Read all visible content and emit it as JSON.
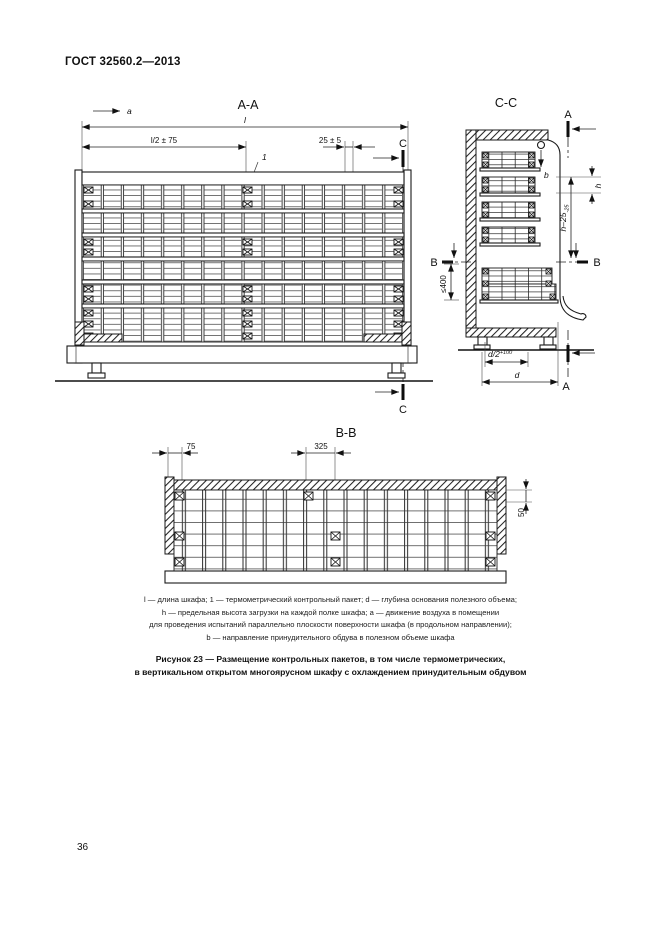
{
  "page": {
    "header": "ГОСТ 32560.2—2013",
    "page_number": "36"
  },
  "drawing": {
    "aa": {
      "title": "А-А",
      "flow_a": "a",
      "dim_l": "l",
      "dim_l2": "l/2 ± 75",
      "dim_25": "25 ± 5",
      "packet_ref": "1",
      "section_c": "С"
    },
    "cc": {
      "title": "С-С",
      "section_a": "А",
      "flow_b": "b",
      "dim_h": "h",
      "dim_hminus": "h–25",
      "dim_hminus_tol": "-25",
      "section_b": "В",
      "dim_400": "≤400",
      "dim_d2": "d/2",
      "dim_d2_tol": "+100",
      "dim_d": "d"
    },
    "bb": {
      "title": "В-В",
      "dim_75": "75",
      "dim_325": "325",
      "dim_50": "50"
    }
  },
  "legend": {
    "lines": [
      "l — длина шкафа; 1 — термометрический контрольный пакет; d — глубина основания полезного объема;",
      "h — предельная высота загрузки на каждой полке шкафа; a — движение воздуха в помещении",
      "для проведения испытаний параллельно плоскости поверхности шкафа (в продольном направлении);",
      "b — направление принудительного обдува в полезном объеме шкафа"
    ]
  },
  "caption": {
    "line1": "Рисунок 23 — Размещение контрольных пакетов, в том числе термометрических,",
    "line2": "в вертикальном открытом многоярусном шкафу с охлаждением принудительным обдувом"
  }
}
